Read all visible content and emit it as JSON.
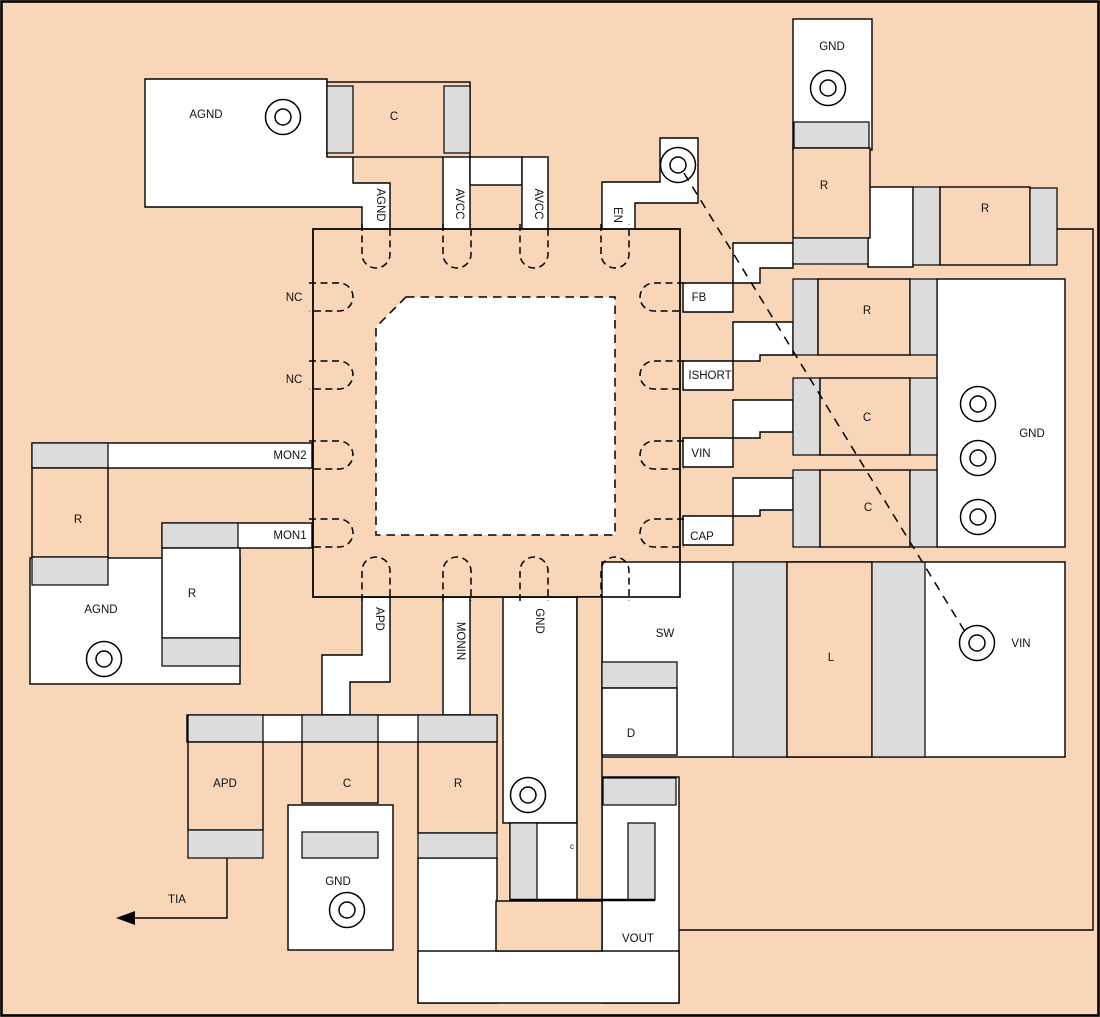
{
  "diagram_type": "pcb-component-placement-layout",
  "colors": {
    "copper": "#f9d6b7",
    "pad": "#dcdcdc",
    "trace": "#ffffff",
    "outline": "#000000"
  },
  "ic": {
    "pins": {
      "top": [
        "AGND",
        "AVCC",
        "AVCC",
        "EN"
      ],
      "left": [
        "NC",
        "NC",
        "MON2",
        "MON1"
      ],
      "right": [
        "FB",
        "ISHORT",
        "VIN",
        "CAP"
      ],
      "bottom": [
        "APD",
        "MONIN",
        "GND"
      ]
    }
  },
  "labels": {
    "agnd_topleft": "AGND",
    "c_topleft": "C",
    "agnd_pin": "AGND",
    "avcc_1": "AVCC",
    "avcc_2": "AVCC",
    "en": "EN",
    "gnd_topright": "GND",
    "r_topright_v": "R",
    "r_topright_h": "R",
    "nc_1": "NC",
    "nc_2": "NC",
    "mon2": "MON2",
    "mon1": "MON1",
    "fb": "FB",
    "ishort": "ISHORT",
    "vin_pin": "VIN",
    "cap_pin": "CAP",
    "r_right": "R",
    "c_right_1": "C",
    "c_right_2": "C",
    "gnd_right": "GND",
    "r_left": "R",
    "agnd_left": "AGND",
    "r_left_2": "R",
    "apd_pin": "APD",
    "monin": "MONIN",
    "gnd_pin": "GND",
    "sw": "SW",
    "d": "D",
    "l": "L",
    "vin_region": "VIN",
    "apd_comp": "APD",
    "c_bottom": "C",
    "r_bottom": "R",
    "gnd_bottom": "GND",
    "tia": "TIA",
    "c_small": "c",
    "vout": "VOUT"
  }
}
